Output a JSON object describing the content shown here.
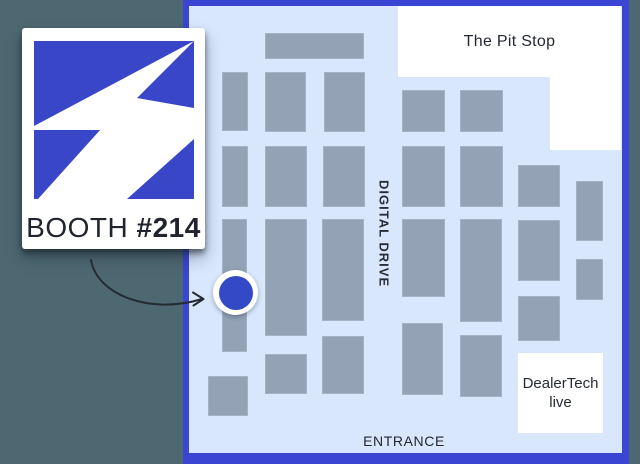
{
  "colors": {
    "background": "#4e6872",
    "accent_blue": "#3a46d3",
    "logo_blue": "#3946c8",
    "marker_blue": "#3349c5",
    "map_bg": "#d8e7fc",
    "booth_fill": "#93a2b5"
  },
  "card": {
    "booth_word": "BOOTH",
    "booth_number": "#214",
    "logo_icon": "lightning-bolt"
  },
  "map": {
    "areas": {
      "pit_stop": {
        "label": "The Pit Stop"
      },
      "dealertech": {
        "line1": "DealerTech",
        "line2": "live"
      }
    },
    "labels": {
      "digital_drive": "DIGITAL DRIVE",
      "entrance": "ENTRANCE"
    },
    "booths": [
      {
        "x": 265,
        "y": 33,
        "w": 99,
        "h": 26
      },
      {
        "x": 222,
        "y": 72,
        "w": 26,
        "h": 59
      },
      {
        "x": 265,
        "y": 72,
        "w": 41,
        "h": 60
      },
      {
        "x": 324,
        "y": 72,
        "w": 41,
        "h": 60
      },
      {
        "x": 402,
        "y": 90,
        "w": 43,
        "h": 42
      },
      {
        "x": 460,
        "y": 90,
        "w": 43,
        "h": 42
      },
      {
        "x": 222,
        "y": 146,
        "w": 26,
        "h": 61
      },
      {
        "x": 265,
        "y": 146,
        "w": 42,
        "h": 61
      },
      {
        "x": 323,
        "y": 146,
        "w": 42,
        "h": 61
      },
      {
        "x": 402,
        "y": 146,
        "w": 43,
        "h": 61
      },
      {
        "x": 460,
        "y": 146,
        "w": 43,
        "h": 61
      },
      {
        "x": 518,
        "y": 165,
        "w": 42,
        "h": 42
      },
      {
        "x": 576,
        "y": 181,
        "w": 27,
        "h": 60
      },
      {
        "x": 222,
        "y": 219,
        "w": 25,
        "h": 133
      },
      {
        "x": 265,
        "y": 219,
        "w": 42,
        "h": 117
      },
      {
        "x": 322,
        "y": 219,
        "w": 42,
        "h": 102
      },
      {
        "x": 402,
        "y": 219,
        "w": 43,
        "h": 78
      },
      {
        "x": 460,
        "y": 219,
        "w": 42,
        "h": 103
      },
      {
        "x": 518,
        "y": 220,
        "w": 42,
        "h": 61
      },
      {
        "x": 576,
        "y": 259,
        "w": 27,
        "h": 41
      },
      {
        "x": 518,
        "y": 296,
        "w": 42,
        "h": 45
      },
      {
        "x": 402,
        "y": 323,
        "w": 41,
        "h": 72
      },
      {
        "x": 460,
        "y": 335,
        "w": 42,
        "h": 62
      },
      {
        "x": 322,
        "y": 336,
        "w": 42,
        "h": 58
      },
      {
        "x": 265,
        "y": 354,
        "w": 42,
        "h": 40
      },
      {
        "x": 208,
        "y": 376,
        "w": 40,
        "h": 40
      }
    ]
  },
  "marker": {
    "icon": "booth-location-dot"
  }
}
